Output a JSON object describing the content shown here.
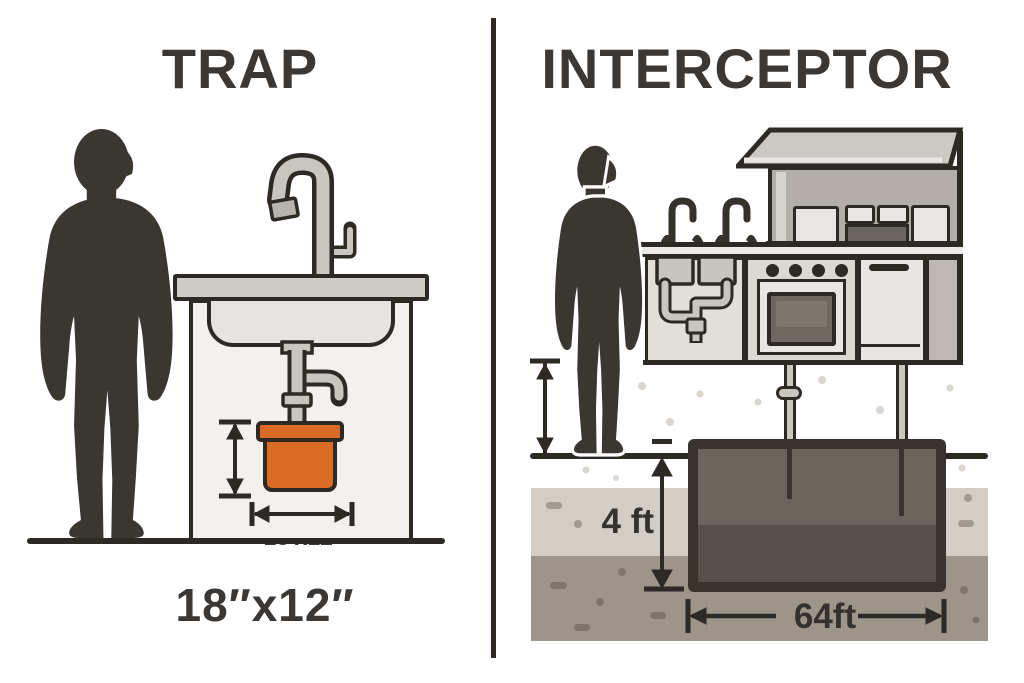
{
  "left_panel": {
    "title": "TRAP",
    "trap_dimension_label": "18′x12′",
    "size_caption": "18″x12″"
  },
  "right_panel": {
    "title": "INTERCEPTOR",
    "depth_label": "4 ft",
    "length_label": "64ft"
  },
  "colors": {
    "ink_outline": "#2d2a26",
    "title_text": "#3a3734",
    "trap_orange": "#d96b25",
    "metal_gray": "#c9c6c1",
    "tank_fill": "#6b645c",
    "tank_lower_fill": "#57504a",
    "tank_outline": "#38332e",
    "soil_upper": "#d2cdc5",
    "soil_lower": "#9d948a"
  }
}
